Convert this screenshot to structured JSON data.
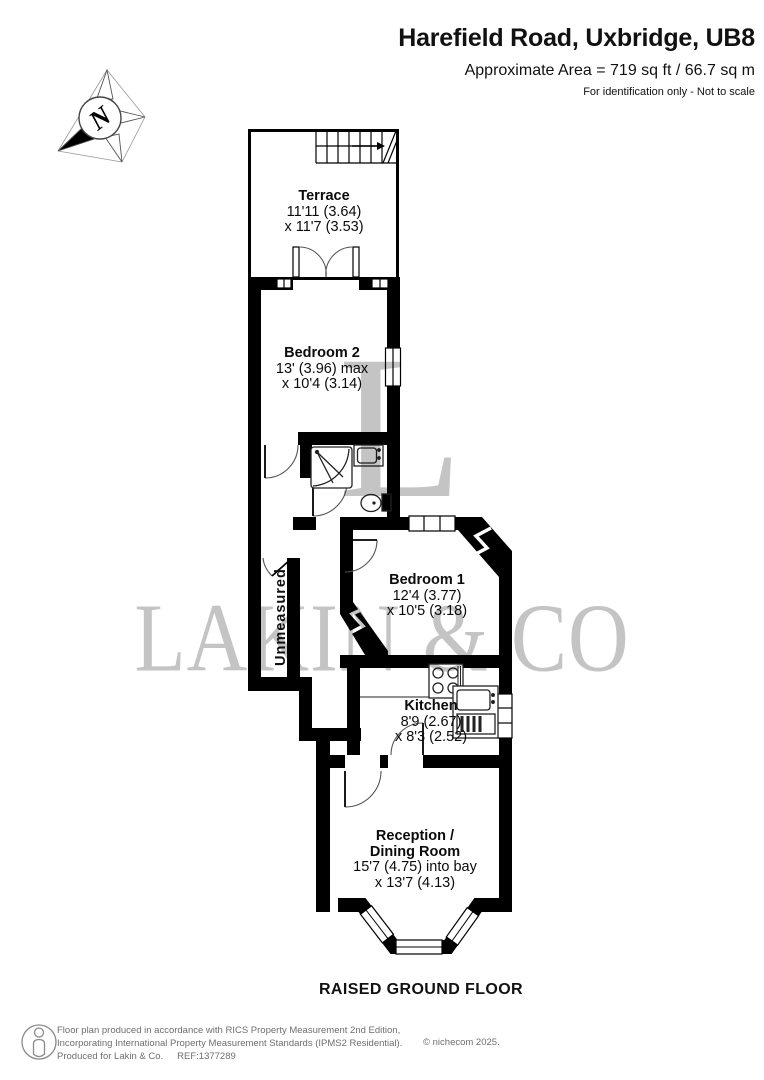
{
  "header": {
    "title": "Harefield Road, Uxbridge, UB8",
    "area_line": "Approximate Area = 719 sq ft / 66.7 sq m",
    "note": "For identification only - Not to scale"
  },
  "compass": {
    "north_label": "N"
  },
  "plan": {
    "rooms": [
      {
        "name": "Terrace",
        "dim1": "11'11 (3.64)",
        "dim2": "x 11'7 (3.53)"
      },
      {
        "name": "Bedroom 2",
        "dim1": "13' (3.96) max",
        "dim2": "x 10'4 (3.14)"
      },
      {
        "name": "Bedroom 1",
        "dim1": "12'4 (3.77)",
        "dim2": "x 10'5 (3.18)"
      },
      {
        "name": "Kitchen",
        "dim1": "8'9 (2.67)",
        "dim2": "x 8'3 (2.52)"
      },
      {
        "name1": "Reception /",
        "name2": "Dining Room",
        "dim1": "15'7 (4.75) into bay",
        "dim2": "x 13'7 (4.13)"
      }
    ],
    "corridor_label": "Unmeasured",
    "floor_label": "RAISED GROUND FLOOR"
  },
  "watermark": {
    "initial": "L",
    "name": "LAKIN & CO"
  },
  "footer": {
    "line1": "Floor plan produced in accordance with RICS Property Measurement 2nd Edition,",
    "line2": "Incorporating International Property Measurement Standards (IPMS2 Residential).",
    "line3": "Produced for Lakin & Co.",
    "ref": "REF:1377289",
    "copyright": "© nichecom 2025."
  },
  "colors": {
    "wall": "#000000",
    "floor": "#ffffff",
    "watermark": "#c4c4c4",
    "footer_text": "#6e6e6e"
  }
}
